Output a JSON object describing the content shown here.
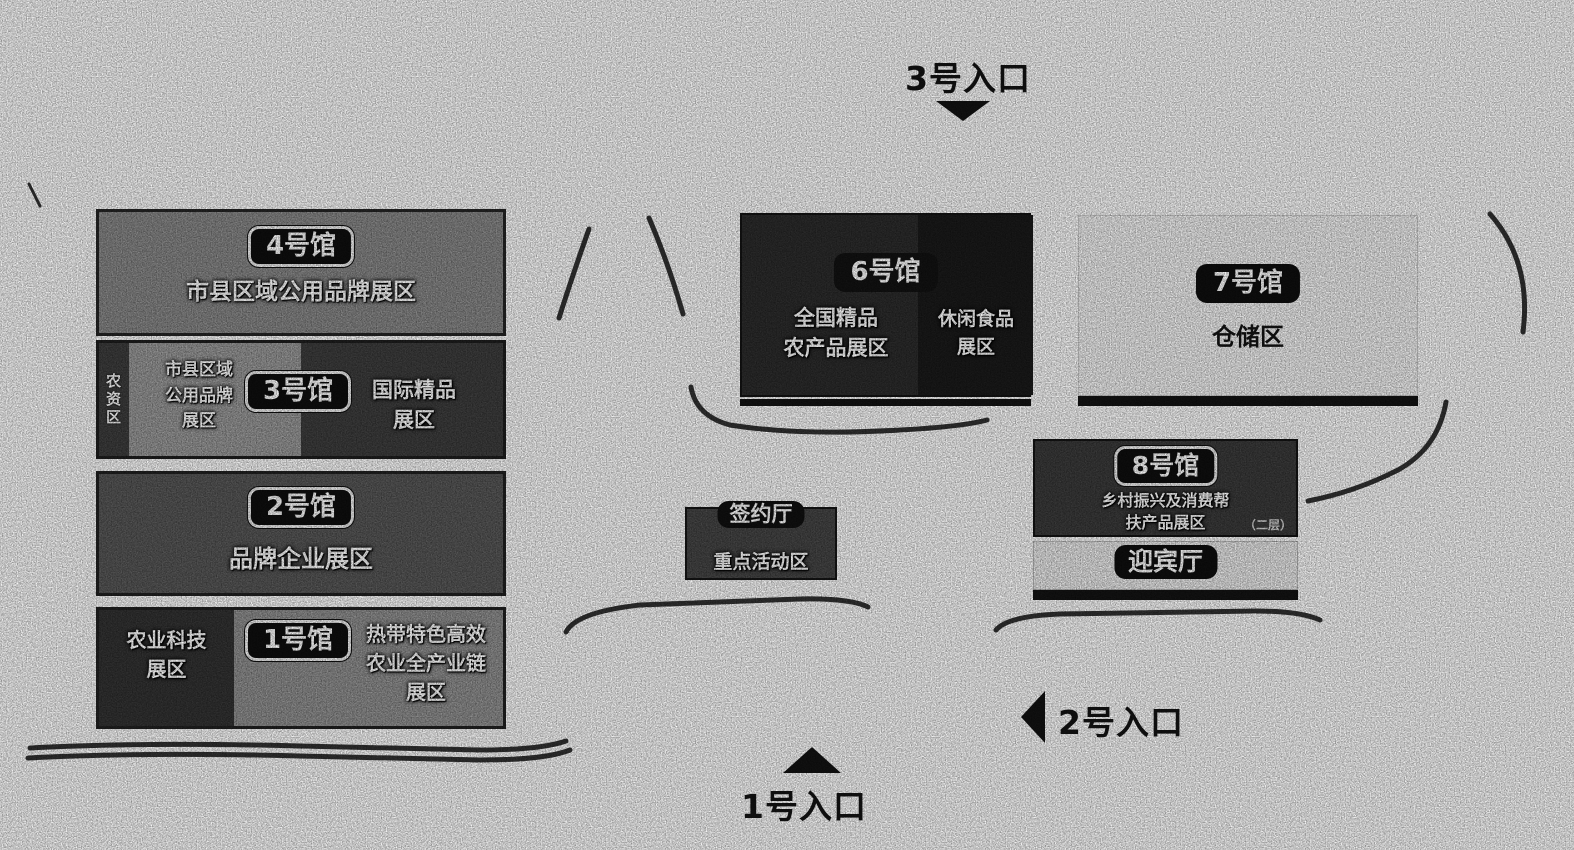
{
  "colors": {
    "page_bg": "#fdfdfd",
    "ink": "#161616",
    "hall4_bg": "#8a8a8a",
    "hall3_bg": "#3f3f3f",
    "hall3_gray_bg": "#9b9b9b",
    "hall2_bg": "#595959",
    "hall1_left_bg": "#343434",
    "hall1_right_bg": "#929292",
    "hall6_bg": "#2d2d2d",
    "hall6_right_bg": "#1b1b1b",
    "hall7_bg": "#f3f3f3",
    "hall8_bg": "#3c3c3c",
    "welcome_bg": "#ebebeb",
    "signing_bg": "#474747",
    "badge_bg": "#0f0f0f",
    "badge_text": "#ffffff"
  },
  "entrances": {
    "e1": {
      "label": "1号入口",
      "arrow": "up-triangle"
    },
    "e2": {
      "label": "2号入口",
      "arrow": "left-triangle"
    },
    "e3": {
      "label": "3号入口",
      "arrow": "down-triangle"
    }
  },
  "halls": {
    "hall4": {
      "badge": "4号馆",
      "zone": "市县区域公用品牌展区"
    },
    "hall3": {
      "badge": "3号馆",
      "strip": "农资区",
      "gray_lines": [
        "市县区域",
        "公用品牌",
        "展区"
      ],
      "right_lines": [
        "国际精品",
        "展区"
      ]
    },
    "hall2": {
      "badge": "2号馆",
      "zone": "品牌企业展区"
    },
    "hall1": {
      "badge": "1号馆",
      "left_lines": [
        "农业科技",
        "展区"
      ],
      "right_lines": [
        "热带特色高效",
        "农业全产业链",
        "展区"
      ]
    },
    "hall6": {
      "badge": "6号馆",
      "left_lines": [
        "全国精品",
        "农产品展区"
      ],
      "right_lines": [
        "休闲食品",
        "展区"
      ]
    },
    "hall7": {
      "badge": "7号馆",
      "zone": "仓储区"
    },
    "hall8": {
      "badge": "8号馆",
      "lines": [
        "乡村振兴及消费帮",
        "扶产品展区"
      ],
      "note": "（二层）"
    },
    "signing": {
      "badge": "签约厅",
      "zone": "重点活动区"
    },
    "welcome": {
      "badge": "迎宾厅"
    }
  }
}
